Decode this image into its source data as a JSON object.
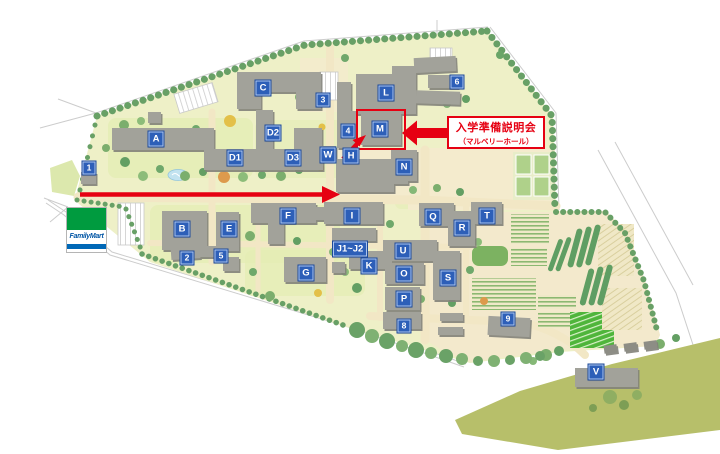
{
  "annotation": {
    "line1": "入学準備説明会",
    "line2": "（マルベリーホール）"
  },
  "store": {
    "name": "FamilyMart"
  },
  "markers": {
    "p1": "1",
    "p2": "2",
    "p3": "3",
    "p4": "4",
    "p5": "5",
    "p6": "6",
    "p8": "8",
    "p9": "9",
    "A": "A",
    "B": "B",
    "C": "C",
    "D1": "D1",
    "D2": "D2",
    "D3": "D3",
    "E": "E",
    "F": "F",
    "G": "G",
    "H": "H",
    "I": "I",
    "J": "J1~J2",
    "K": "K",
    "L": "L",
    "M": "M",
    "N": "N",
    "O": "O",
    "P": "P",
    "Q": "Q",
    "R": "R",
    "S": "S",
    "T": "T",
    "U": "U",
    "V": "V",
    "W": "W"
  },
  "colors": {
    "highlight_red": "#e60012",
    "marker_blue": "#2d5fb8",
    "familymart_green": "#009b3f",
    "familymart_blue": "#0068b7"
  }
}
